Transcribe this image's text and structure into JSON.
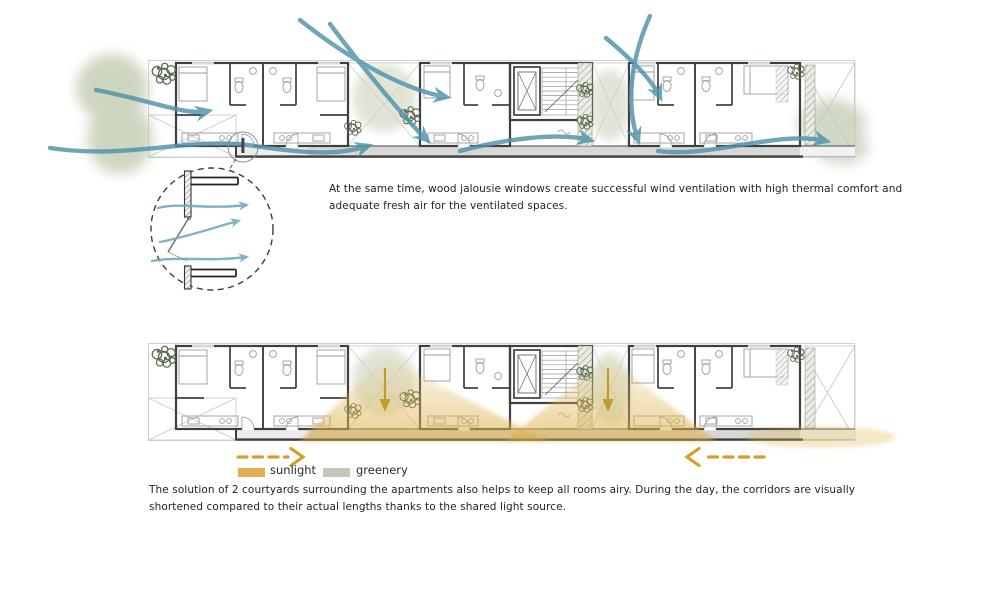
{
  "title": "apartment block ventilation and daylight diagrams",
  "wind_section": {
    "caption": "At the same time, wood jalousie windows create successful wind ventilation with high thermal comfort and adequate fresh air for the ventilated spaces."
  },
  "daylight_section": {
    "caption": "The solution of 2 courtyards surrounding the apartments also helps to keep all rooms airy. During the day, the corridors are visually shortened compared to their actual lengths thanks to the shared light source.",
    "legend": {
      "sunlight": "sunlight",
      "greenery": "greenery"
    }
  },
  "colors": {
    "wind_arrow": "#4f93a8",
    "sunlight_beam": "#ddb057",
    "sunlight_arrow": "#d2a02b",
    "greenery": "#c6cfb7",
    "wall": "#3f3f3f",
    "corridor": "#d7d7d7"
  }
}
